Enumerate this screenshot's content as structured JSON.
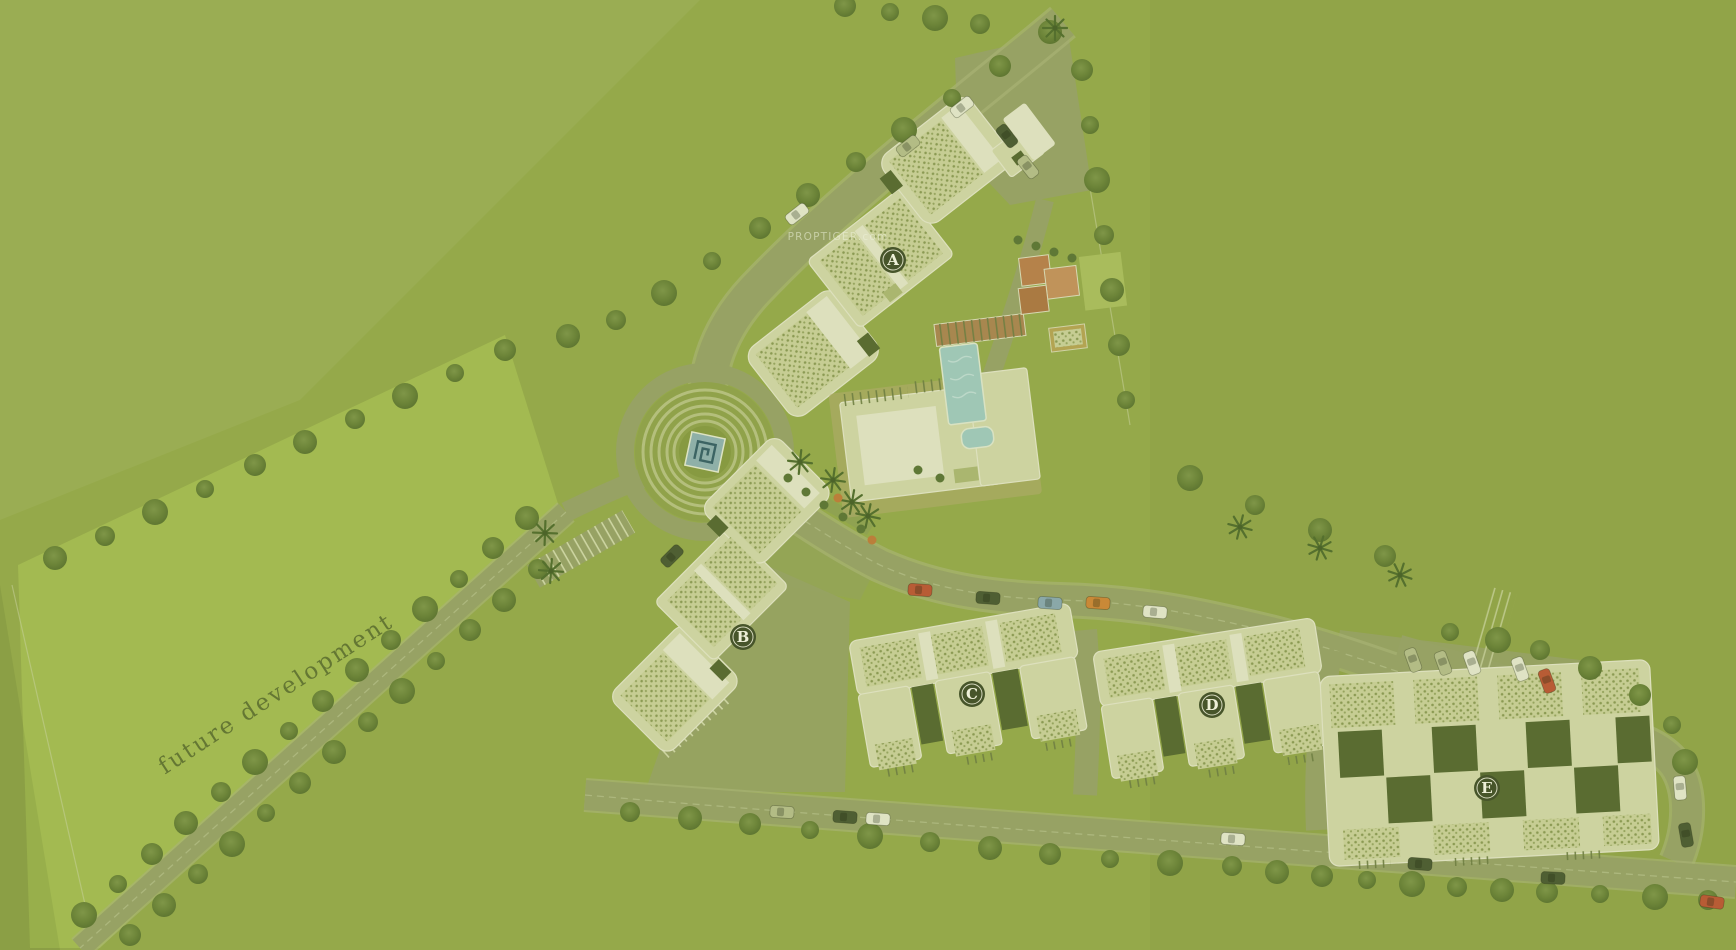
{
  "watermark": {
    "text": "PROPTIGER.com"
  },
  "labels": {
    "future_area": "future development"
  },
  "map": {
    "colors": {
      "grass": "#95a94a",
      "parcel": "#a4bb52",
      "road": "#97a264",
      "road_casing": "#a9b475",
      "roof": "#cdd3a0",
      "roof_bright": "#dde0bd",
      "roof_dark": "#5a6c31",
      "pool": "#9fc7b5",
      "court": "#b5824a",
      "marker": "#47552a",
      "marker_text": "#eef0d8"
    },
    "buildings": [
      {
        "id": "A",
        "x": 893,
        "y": 260
      },
      {
        "id": "B",
        "x": 743,
        "y": 637
      },
      {
        "id": "C",
        "x": 972,
        "y": 694
      },
      {
        "id": "D",
        "x": 1212,
        "y": 705
      },
      {
        "id": "E",
        "x": 1487,
        "y": 788
      }
    ],
    "car_colors": {
      "white": "#dfe3c4",
      "gray": "#b3bc85",
      "dark": "#4f5f33",
      "red": "#b85c35",
      "blue": "#8aa8a8",
      "orange": "#c98937"
    },
    "cars": [
      [
        962,
        107,
        -38,
        "white"
      ],
      [
        908,
        146,
        -38,
        "gray"
      ],
      [
        1007,
        136,
        52,
        "dark"
      ],
      [
        1028,
        167,
        52,
        "gray"
      ],
      [
        797,
        214,
        -38,
        "white"
      ],
      [
        920,
        590,
        4,
        "red"
      ],
      [
        988,
        598,
        4,
        "dark"
      ],
      [
        1050,
        603,
        4,
        "blue"
      ],
      [
        1098,
        603,
        4,
        "orange"
      ],
      [
        1155,
        612,
        5,
        "white"
      ],
      [
        672,
        556,
        -45,
        "dark"
      ],
      [
        1413,
        660,
        70,
        "gray"
      ],
      [
        1443,
        663,
        70,
        "gray"
      ],
      [
        1472,
        663,
        70,
        "white"
      ],
      [
        1520,
        669,
        70,
        "white"
      ],
      [
        1547,
        681,
        70,
        "red"
      ],
      [
        1680,
        788,
        85,
        "white"
      ],
      [
        1686,
        835,
        80,
        "dark"
      ],
      [
        782,
        812,
        4,
        "gray"
      ],
      [
        845,
        817,
        4,
        "dark"
      ],
      [
        878,
        819,
        4,
        "white"
      ],
      [
        1233,
        839,
        4,
        "white"
      ],
      [
        1420,
        864,
        4,
        "dark"
      ],
      [
        1553,
        878,
        3,
        "dark"
      ],
      [
        1712,
        902,
        8,
        "red"
      ]
    ],
    "trees": {
      "round": [
        [
          845,
          6
        ],
        [
          890,
          12
        ],
        [
          935,
          18
        ],
        [
          980,
          24
        ],
        [
          1050,
          32
        ],
        [
          1000,
          66
        ],
        [
          952,
          98
        ],
        [
          904,
          130
        ],
        [
          856,
          162
        ],
        [
          808,
          195
        ],
        [
          760,
          228
        ],
        [
          712,
          261
        ],
        [
          664,
          293
        ],
        [
          616,
          320
        ],
        [
          568,
          336
        ],
        [
          505,
          350
        ],
        [
          455,
          373
        ],
        [
          405,
          396
        ],
        [
          355,
          419
        ],
        [
          305,
          442
        ],
        [
          255,
          465
        ],
        [
          205,
          489
        ],
        [
          155,
          512
        ],
        [
          105,
          536
        ],
        [
          55,
          558
        ],
        [
          1082,
          70
        ],
        [
          1090,
          125
        ],
        [
          1097,
          180
        ],
        [
          1104,
          235
        ],
        [
          1112,
          290
        ],
        [
          1119,
          345
        ],
        [
          1126,
          400
        ],
        [
          1190,
          478
        ],
        [
          1255,
          505
        ],
        [
          1320,
          530
        ],
        [
          1385,
          556
        ],
        [
          1450,
          632
        ],
        [
          1498,
          640
        ],
        [
          1540,
          650
        ],
        [
          1590,
          668
        ],
        [
          1640,
          695
        ],
        [
          1672,
          725
        ],
        [
          1685,
          762
        ],
        [
          630,
          812
        ],
        [
          690,
          818
        ],
        [
          750,
          824
        ],
        [
          810,
          830
        ],
        [
          870,
          836
        ],
        [
          930,
          842
        ],
        [
          990,
          848
        ],
        [
          1050,
          854
        ],
        [
          1110,
          859
        ],
        [
          1170,
          863
        ],
        [
          1232,
          866
        ],
        [
          1277,
          872
        ],
        [
          1322,
          876
        ],
        [
          1367,
          880
        ],
        [
          1412,
          884
        ],
        [
          1457,
          887
        ],
        [
          1502,
          890
        ],
        [
          1547,
          892
        ],
        [
          1600,
          894
        ],
        [
          1655,
          897
        ],
        [
          1708,
          900
        ],
        [
          527,
          518
        ],
        [
          493,
          548
        ],
        [
          459,
          579
        ],
        [
          425,
          609
        ],
        [
          391,
          640
        ],
        [
          357,
          670
        ],
        [
          323,
          701
        ],
        [
          289,
          731
        ],
        [
          255,
          762
        ],
        [
          221,
          792
        ],
        [
          186,
          823
        ],
        [
          152,
          854
        ],
        [
          118,
          884
        ],
        [
          84,
          915
        ],
        [
          538,
          569
        ],
        [
          504,
          600
        ],
        [
          470,
          630
        ],
        [
          436,
          661
        ],
        [
          402,
          691
        ],
        [
          368,
          722
        ],
        [
          334,
          752
        ],
        [
          300,
          783
        ],
        [
          266,
          813
        ],
        [
          232,
          844
        ],
        [
          198,
          874
        ],
        [
          164,
          905
        ],
        [
          130,
          935
        ]
      ],
      "palm": [
        [
          1055,
          28
        ],
        [
          545,
          533
        ],
        [
          551,
          571
        ],
        [
          800,
          462
        ],
        [
          833,
          480
        ],
        [
          852,
          502
        ],
        [
          868,
          516
        ],
        [
          1240,
          527
        ],
        [
          1320,
          548
        ],
        [
          1400,
          575
        ]
      ],
      "shrub": [
        [
          788,
          478
        ],
        [
          806,
          492
        ],
        [
          824,
          505
        ],
        [
          843,
          517
        ],
        [
          861,
          529
        ],
        [
          1018,
          240
        ],
        [
          1036,
          246
        ],
        [
          1054,
          252
        ],
        [
          1072,
          258
        ],
        [
          918,
          470
        ],
        [
          940,
          478
        ]
      ],
      "shrub_accent": [
        [
          838,
          498
        ],
        [
          872,
          540
        ]
      ]
    }
  }
}
